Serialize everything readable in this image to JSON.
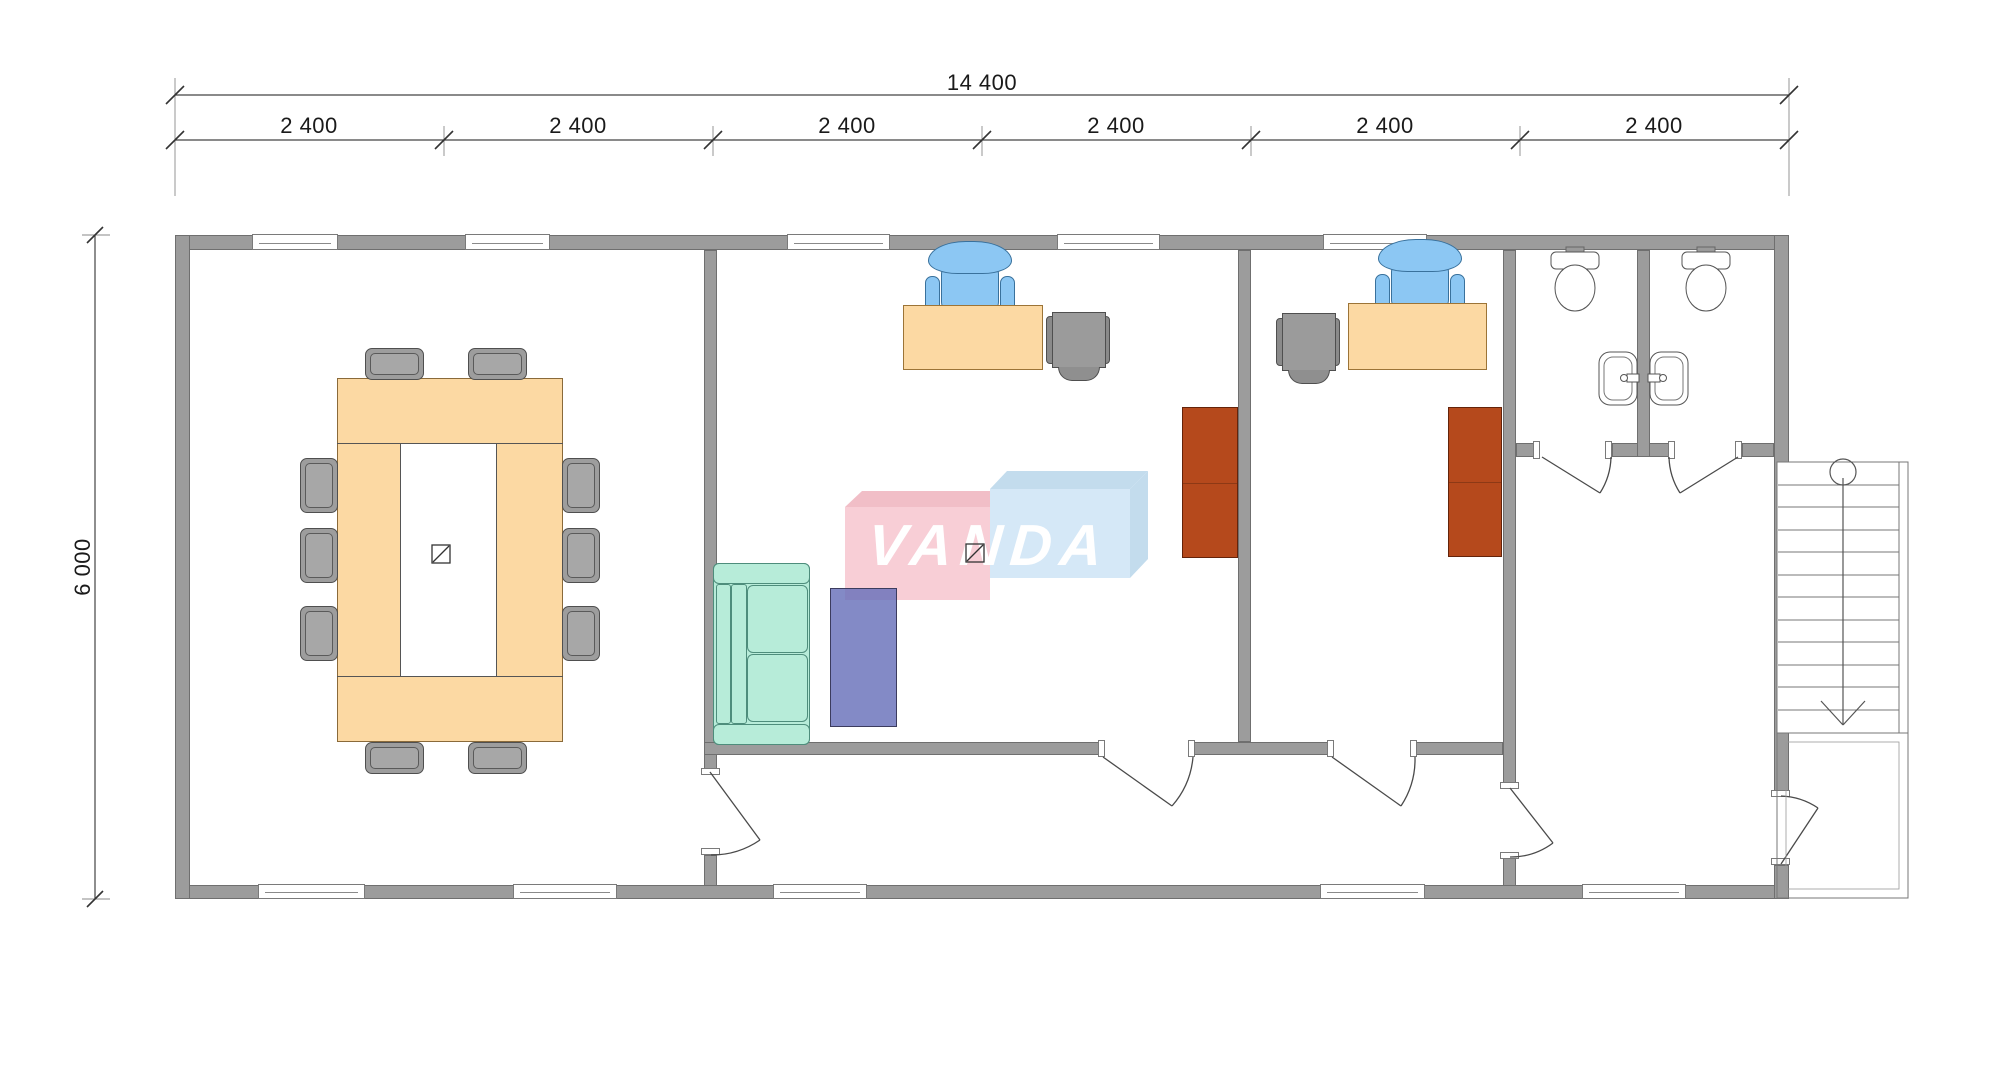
{
  "drawing": {
    "type": "office-floor-plan",
    "units": "mm"
  },
  "dimensions": {
    "total_width": "14 400",
    "modules": [
      "2 400",
      "2 400",
      "2 400",
      "2 400",
      "2 400",
      "2 400"
    ],
    "height": "6 000"
  },
  "watermark": {
    "text": "VANDA",
    "pink_box_color": "#f8cdd5",
    "blue_box_color": "#d4e8f7",
    "text_color": "#ffffff"
  },
  "colors": {
    "wall_fill": "#9c9c9c",
    "wall_edge": "#6f6f6f",
    "desk_fill": "#fcd9a3",
    "gray_chair_fill": "#9d9d9d",
    "office_chair_blue": "#8cc7f3",
    "wardrobe_rust": "#b5491c",
    "sofa_teal": "#b7ecd9",
    "low_table_purple": "#7b86c4",
    "line_thin": "#4a4a4a"
  },
  "rooms": [
    {
      "name": "conference-room",
      "furniture": [
        "conference-table",
        "conference-chairs-x10",
        "floor-symbol"
      ]
    },
    {
      "name": "office-1",
      "furniture": [
        "desk",
        "office-chair",
        "guest-chair",
        "sofa",
        "low-table",
        "wardrobe"
      ]
    },
    {
      "name": "office-2",
      "furniture": [
        "desk",
        "office-chair",
        "guest-chair",
        "wardrobe"
      ]
    },
    {
      "name": "corridor",
      "furniture": []
    },
    {
      "name": "wc-stall-1",
      "furniture": [
        "toilet",
        "sink"
      ]
    },
    {
      "name": "wc-stall-2",
      "furniture": [
        "toilet",
        "sink"
      ]
    },
    {
      "name": "entrance-hall",
      "furniture": []
    },
    {
      "name": "staircase",
      "furniture": [
        "stair-flight-down",
        "landing"
      ]
    }
  ]
}
